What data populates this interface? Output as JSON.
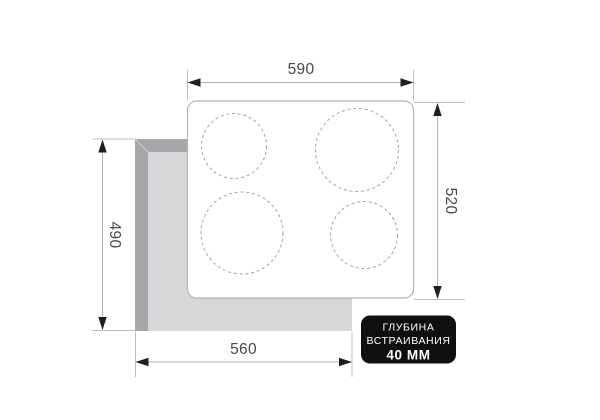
{
  "diagram": {
    "type": "built-in hob installation dimensions drawing",
    "dims": {
      "top": {
        "value": "590",
        "meaning": "hob width"
      },
      "right": {
        "value": "520",
        "meaning": "hob depth"
      },
      "left": {
        "value": "490",
        "meaning": "cutout depth"
      },
      "bottom": {
        "value": "560",
        "meaning": "cutout width"
      }
    },
    "badge": {
      "line1": "ГЛУБИНА",
      "line2": "ВСТРАИВАНИЯ",
      "line3": "40 ММ"
    },
    "burners_count": 4,
    "colors": {
      "background": "#ffffff",
      "cutout_wall_dark": "#a6a6aa",
      "cutout_floor_light": "#d7d7d9",
      "cooktop_outline": "#b4b4b7",
      "burner_dash": "#a3a3a7",
      "dimension_line": "#b4b4b8",
      "arrow": "#1e1e22",
      "dimension_text": "#47474b",
      "badge_bg": "#0f0f0f",
      "badge_text": "#ffffff"
    }
  }
}
